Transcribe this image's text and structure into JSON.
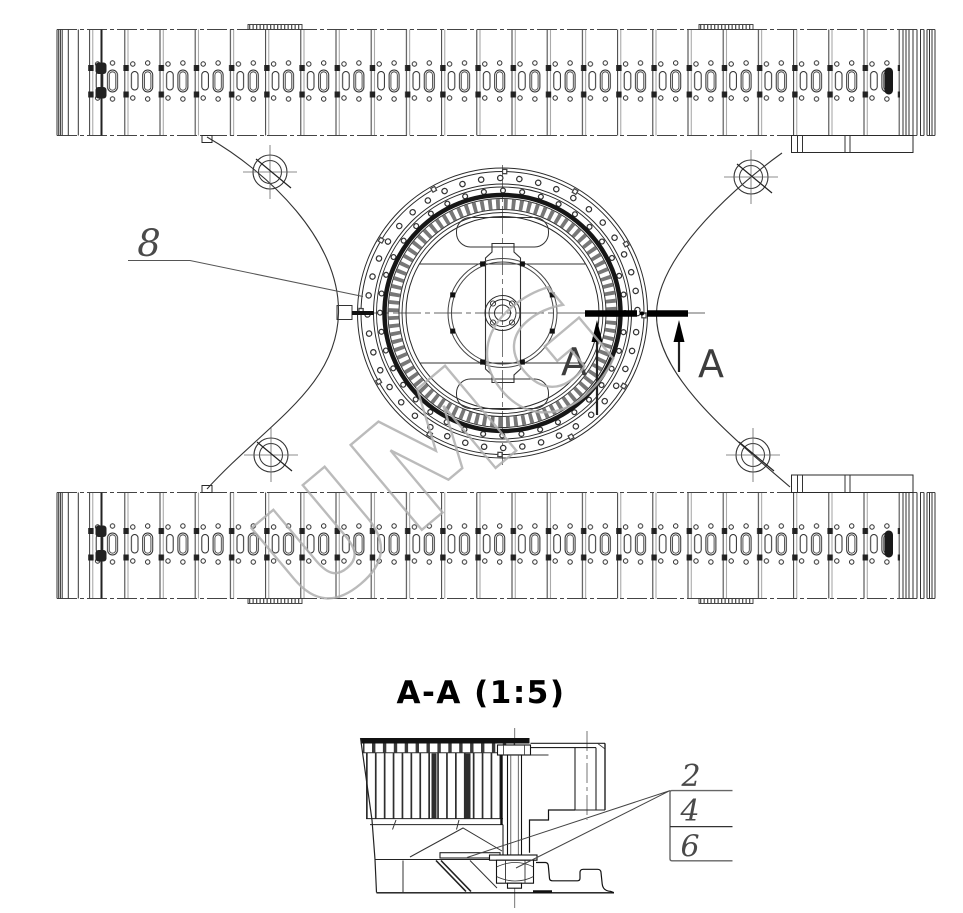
{
  "watermark": {
    "text": "UMG",
    "color": "#b0b0b0"
  },
  "plan_view": {
    "part_callout": {
      "number": "8"
    },
    "section_cut": {
      "label_left": "A",
      "label_right": "A"
    }
  },
  "section_view": {
    "title": "A-A (1:5)",
    "callouts": [
      {
        "number": "2"
      },
      {
        "number": "4"
      },
      {
        "number": "6"
      }
    ]
  },
  "colors": {
    "line": "#222222",
    "dark": "#111111",
    "centerline": "#666666",
    "watermark": "#b0b0b0",
    "background": "#ffffff"
  }
}
